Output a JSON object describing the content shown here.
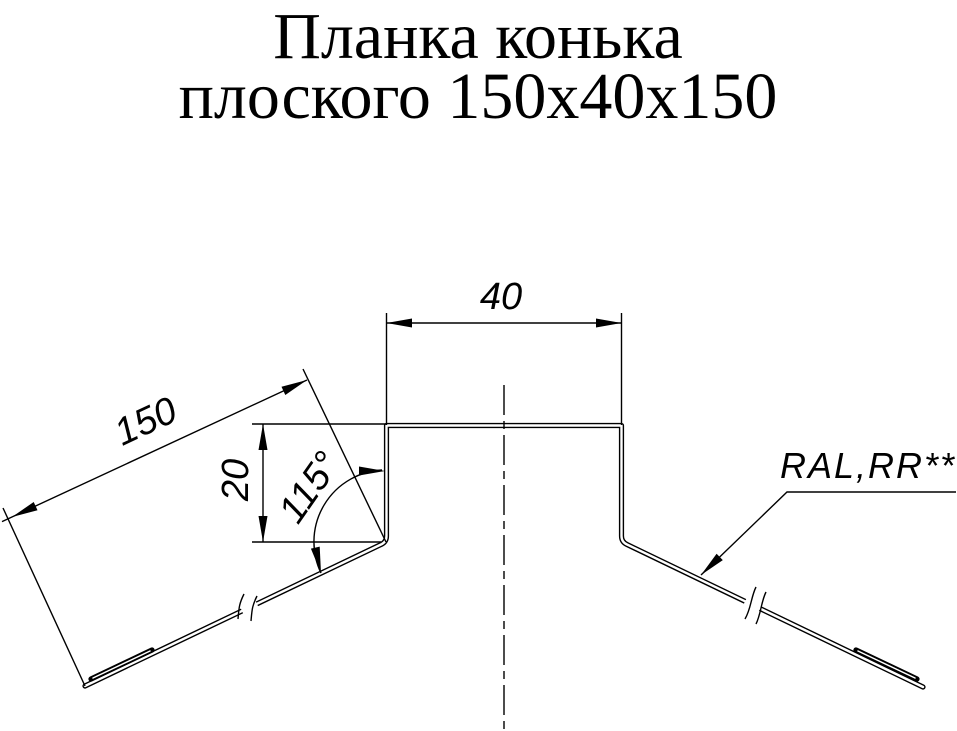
{
  "title": {
    "line1": "Планка конька",
    "line2": "плоского 150x40x150"
  },
  "dimensions": {
    "top_width": "40",
    "flange_length": "150",
    "riser_height": "20",
    "bend_angle": "115°"
  },
  "coating_note": {
    "label": "RAL,RR**"
  },
  "colors": {
    "line": "#000000",
    "background": "#ffffff"
  }
}
